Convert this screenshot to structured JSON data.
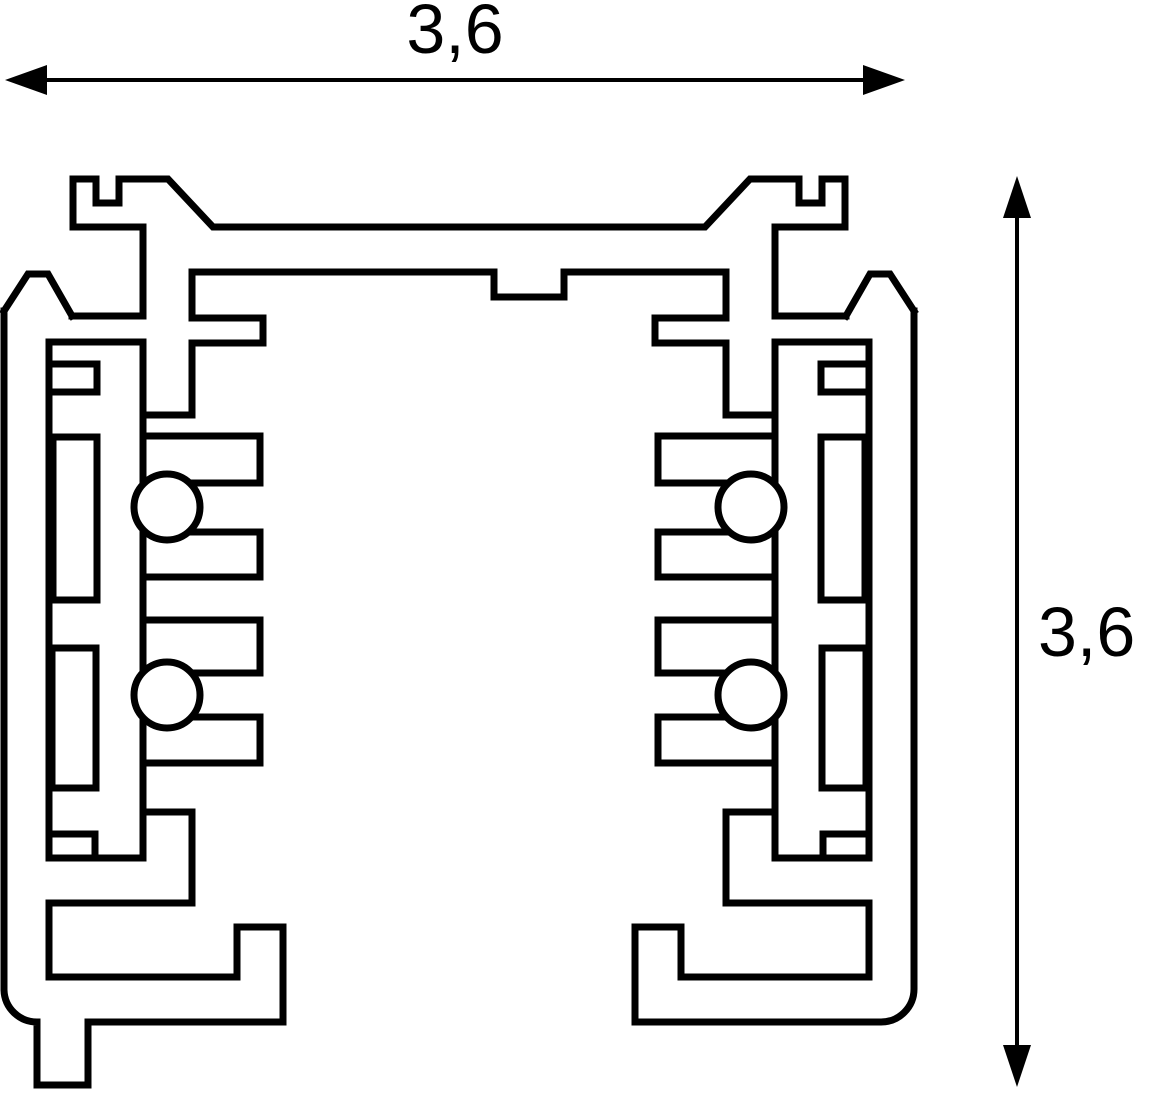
{
  "dimensions": {
    "width_label": "3,6",
    "height_label": "3,6"
  },
  "drawing": {
    "background": "#ffffff",
    "line_color": "#000000",
    "profile_stroke_width": 7,
    "dim_stroke_width": 4,
    "mirror_x": 918,
    "static_polylines": [
      [
        [
          143,
          227
        ],
        [
          73,
          227
        ],
        [
          73,
          179
        ],
        [
          96,
          179
        ],
        [
          96,
          203
        ],
        [
          119,
          203
        ],
        [
          119,
          179
        ],
        [
          168,
          179
        ],
        [
          213,
          227
        ],
        [
          705,
          227
        ],
        [
          750,
          179
        ],
        [
          799,
          179
        ],
        [
          799,
          203
        ],
        [
          822,
          203
        ],
        [
          822,
          179
        ],
        [
          845,
          179
        ],
        [
          845,
          227
        ],
        [
          775,
          227
        ]
      ],
      [
        [
          192,
          272
        ],
        [
          494,
          272
        ],
        [
          494,
          297
        ],
        [
          564,
          297
        ],
        [
          564,
          272
        ],
        [
          726,
          272
        ]
      ]
    ],
    "static_paths": [
      "M4,311 L4,990 A33,33 0 0 0 37,1022 L37,1085 L88,1085 L88,1022 L283,1022",
      "M914,311 L914,989 A33,33 0 0 1 881,1022 L635,1022"
    ],
    "mirrored_polylines": [
      [
        [
          4,
          311
        ],
        [
          28,
          274
        ],
        [
          48,
          274
        ],
        [
          72,
          316
        ]
      ],
      [
        [
          72,
          316
        ],
        [
          143,
          316
        ]
      ],
      [
        [
          49,
          342
        ],
        [
          143,
          342
        ]
      ],
      [
        [
          49,
          342
        ],
        [
          49,
          858
        ]
      ],
      [
        [
          49,
          903
        ],
        [
          49,
          977
        ]
      ],
      [
        [
          143,
          227
        ],
        [
          143,
          316
        ]
      ],
      [
        [
          143,
          342
        ],
        [
          143,
          858
        ]
      ],
      [
        [
          192,
          272
        ],
        [
          192,
          318
        ]
      ],
      [
        [
          192,
          343
        ],
        [
          192,
          415
        ]
      ],
      [
        [
          143,
          415
        ],
        [
          192,
          415
        ]
      ],
      [
        [
          192,
          318
        ],
        [
          263,
          318
        ]
      ],
      [
        [
          263,
          318
        ],
        [
          263,
          343
        ]
      ],
      [
        [
          192,
          343
        ],
        [
          263,
          343
        ]
      ],
      [
        [
          49,
          364
        ],
        [
          97,
          364
        ],
        [
          97,
          392
        ],
        [
          49,
          392
        ]
      ],
      [
        [
          53,
          437
        ],
        [
          97,
          437
        ],
        [
          97,
          600
        ],
        [
          53,
          600
        ],
        [
          53,
          437
        ]
      ],
      [
        [
          52,
          648
        ],
        [
          96,
          648
        ],
        [
          96,
          788
        ],
        [
          52,
          788
        ],
        [
          52,
          648
        ]
      ],
      [
        [
          143,
          436
        ],
        [
          260,
          436
        ]
      ],
      [
        [
          143,
          483
        ],
        [
          260,
          483
        ]
      ],
      [
        [
          143,
          532
        ],
        [
          260,
          532
        ]
      ],
      [
        [
          143,
          577
        ],
        [
          260,
          577
        ]
      ],
      [
        [
          143,
          620
        ],
        [
          260,
          620
        ]
      ],
      [
        [
          143,
          673
        ],
        [
          260,
          673
        ]
      ],
      [
        [
          143,
          717
        ],
        [
          260,
          717
        ]
      ],
      [
        [
          143,
          763
        ],
        [
          260,
          763
        ]
      ],
      [
        [
          260,
          436
        ],
        [
          260,
          483
        ]
      ],
      [
        [
          260,
          532
        ],
        [
          260,
          577
        ]
      ],
      [
        [
          260,
          620
        ],
        [
          260,
          673
        ]
      ],
      [
        [
          260,
          717
        ],
        [
          260,
          763
        ]
      ],
      [
        [
          49,
          834
        ],
        [
          95,
          834
        ],
        [
          95,
          858
        ]
      ],
      [
        [
          49,
          858
        ],
        [
          143,
          858
        ]
      ],
      [
        [
          143,
          812
        ],
        [
          192,
          812
        ]
      ],
      [
        [
          192,
          812
        ],
        [
          192,
          903
        ]
      ],
      [
        [
          49,
          903
        ],
        [
          192,
          903
        ]
      ],
      [
        [
          49,
          977
        ],
        [
          237,
          977
        ]
      ],
      [
        [
          237,
          927
        ],
        [
          237,
          977
        ]
      ],
      [
        [
          237,
          927
        ],
        [
          283,
          927
        ]
      ],
      [
        [
          283,
          927
        ],
        [
          283,
          1022
        ]
      ]
    ],
    "mirrored_circles": [
      {
        "cx": 167,
        "cy": 507,
        "r": 33
      },
      {
        "cx": 167,
        "cy": 695,
        "r": 33
      }
    ],
    "arrows": [
      {
        "name": "width-dimension-arrow",
        "line": [
          [
            47,
            80
          ],
          [
            863,
            80
          ]
        ],
        "heads": [
          [
            [
              5,
              80
            ],
            [
              47,
              65
            ],
            [
              47,
              95
            ]
          ],
          [
            [
              905,
              80
            ],
            [
              863,
              65
            ],
            [
              863,
              95
            ]
          ]
        ]
      },
      {
        "name": "height-dimension-arrow",
        "line": [
          [
            1017,
            218
          ],
          [
            1017,
            1046
          ]
        ],
        "heads": [
          [
            [
              1017,
              176
            ],
            [
              1003,
              218
            ],
            [
              1031,
              218
            ]
          ],
          [
            [
              1017,
              1087
            ],
            [
              1003,
              1045
            ],
            [
              1031,
              1045
            ]
          ]
        ]
      }
    ]
  }
}
